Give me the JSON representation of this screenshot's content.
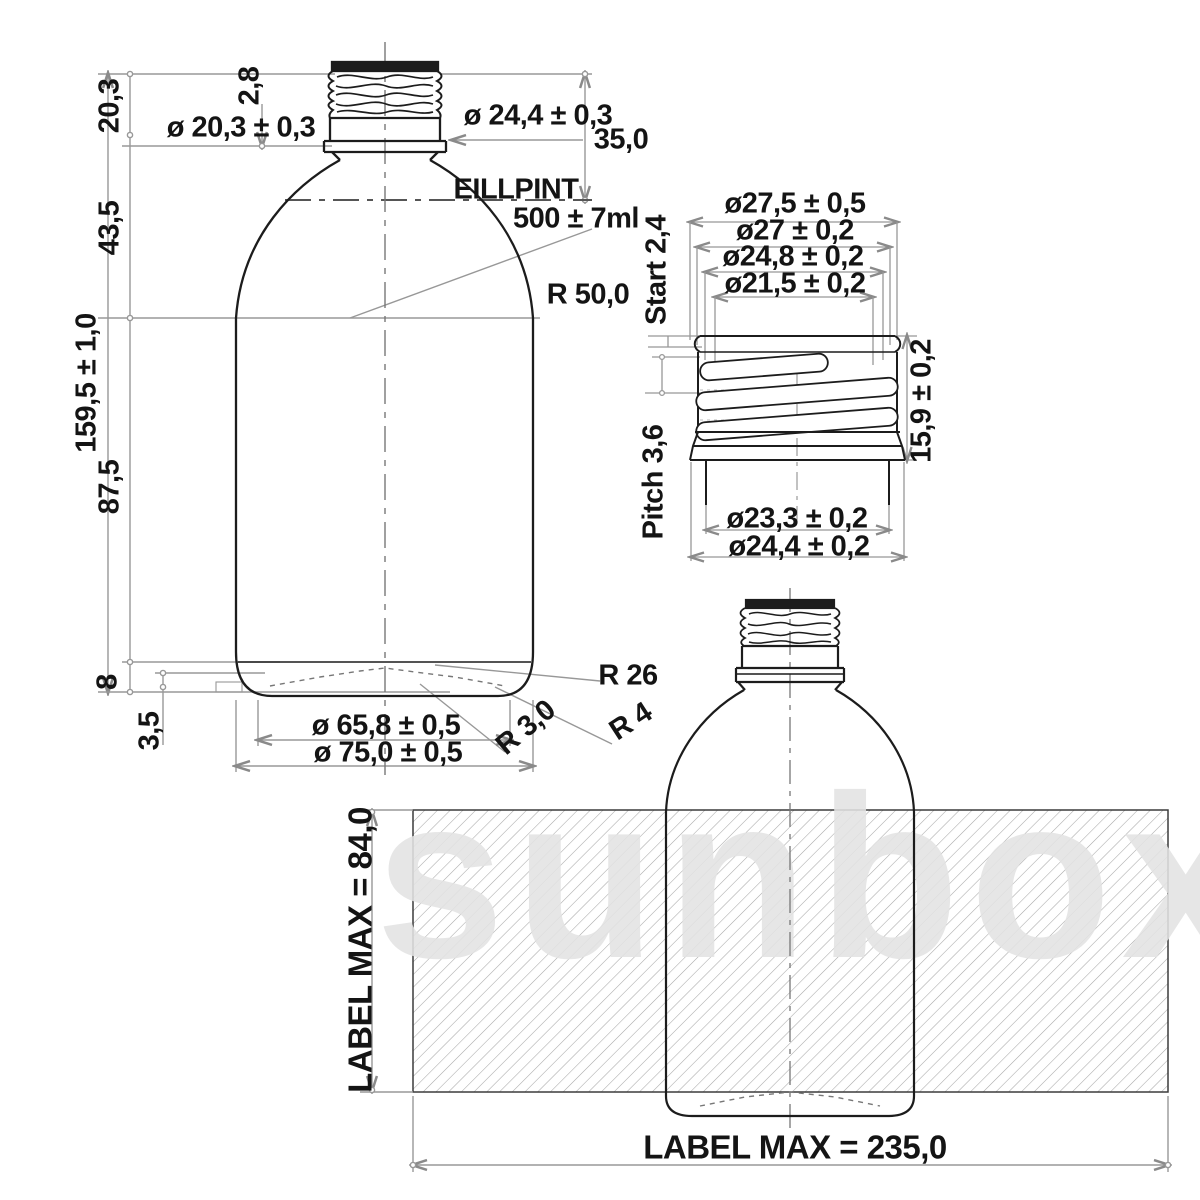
{
  "drawing": {
    "watermark": "sunbox",
    "colors": {
      "line": "#1c1c1c",
      "dimension": "#989898",
      "text": "#141414",
      "hatch": "#a8a8a8",
      "watermark_gray": "#e2e2e2"
    },
    "main_view": {
      "height_neck_finish": "20,3",
      "height_shoulder": "43,5",
      "height_total": "159,5 ± 1,0",
      "height_body": "87,5",
      "height_base": "8",
      "height_heel": "3,5",
      "neck_bore_dia": "ø 20,3 ± 0,3",
      "thread_depth": "2,8",
      "neck_outer_dia": "ø 24,4 ± 0,3",
      "neck_height": "35,0",
      "fill_point_title": "EILLPINT",
      "fill_point_volume": "500 ± 7ml",
      "shoulder_radius": "R 50,0",
      "heel_radius_26": "R 26",
      "heel_radius_4": "R 4",
      "heel_radius_3": "R 3,0",
      "base_dia_inner": "ø 65,8 ± 0,5",
      "base_dia_outer": "ø 75,0 ± 0,5"
    },
    "neck_detail": {
      "dia_bead": "ø27,5 ± 0,5",
      "dia_thread_crest": "ø27 ± 0,2",
      "dia_thread_root": "ø24,8 ± 0,2",
      "dia_bore": "ø21,5 ± 0,2",
      "thread_start": "Start 2,4",
      "thread_pitch": "Pitch 3,6",
      "finish_height": "15,9 ± 0,2",
      "dia_under_flange": "ø23,3 ± 0,2",
      "dia_flange": "ø24,4 ± 0,2"
    },
    "label_view": {
      "label_height": "LABEL MAX = 84,0",
      "label_width": "LABEL MAX = 235,0"
    }
  }
}
